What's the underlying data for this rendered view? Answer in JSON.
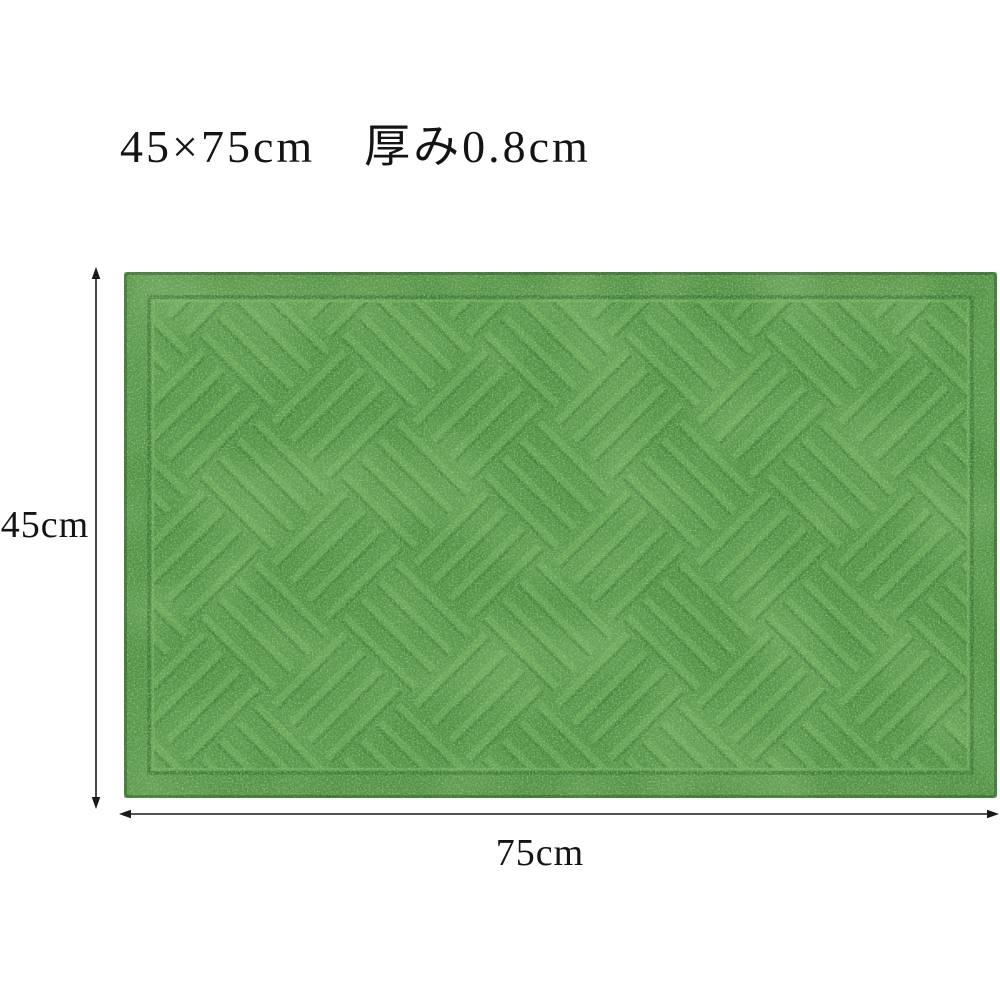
{
  "page": {
    "background": "#ffffff"
  },
  "title": {
    "text": "45×75cm　厚み0.8cm"
  },
  "diagram": {
    "height_dimension": {
      "label": "45cm"
    },
    "width_dimension": {
      "label": "75cm"
    },
    "arrow_color": "#1a1a1a",
    "mat": {
      "description": "green artificial grass doormat with diagonal basketweave emboss and inner groove border",
      "colors": {
        "base": "#4c8f3e",
        "dark_speckle": "#295e23",
        "light_speckle": "#a0d985",
        "mottle": "#76b95c",
        "groove": "#2a5f24",
        "ridge": "#86c86a",
        "edge_shade": "rgba(25,70,25,0.35)"
      }
    }
  }
}
